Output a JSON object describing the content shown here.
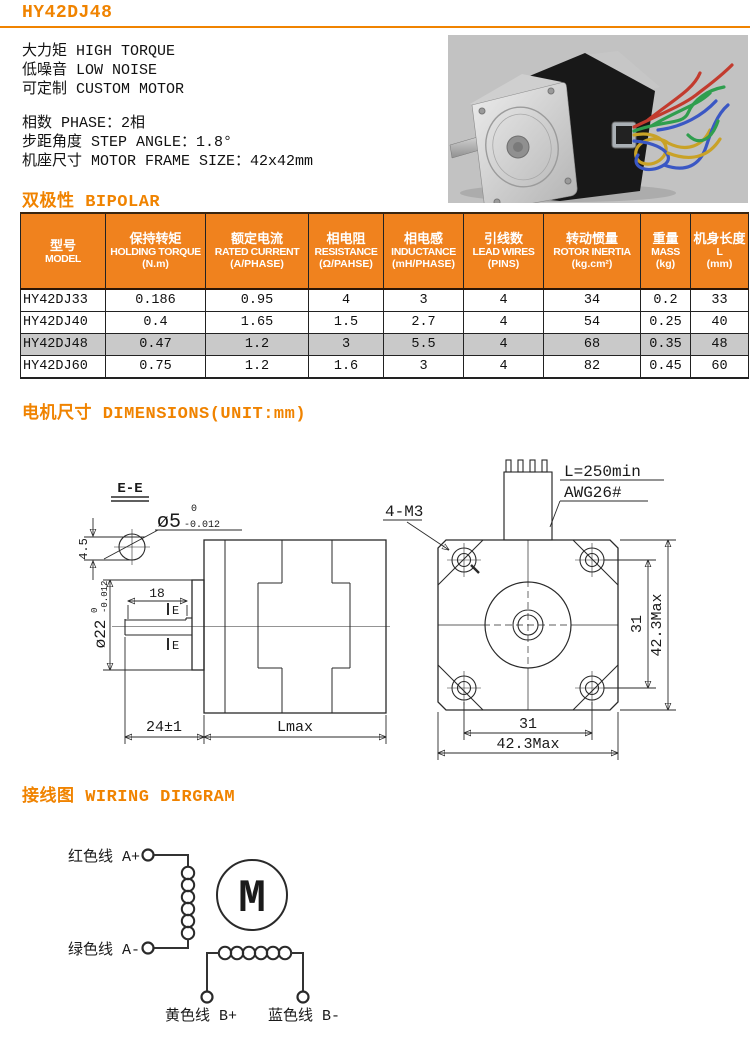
{
  "page": {
    "title": "HY42DJ48"
  },
  "colors": {
    "accent": "#F08300",
    "table_header_bg": "#F0821E",
    "highlight_row": "#C9C9C9",
    "photo_background": "#C2C2C2",
    "wire_colors": {
      "red": "#C23B2E",
      "green": "#2F9E4E",
      "blue": "#3A57C4",
      "yellow": "#C9A227"
    }
  },
  "intro": {
    "features": [
      "大力矩 HIGH TORQUE",
      "低噪音 LOW NOISE",
      "可定制 CUSTOM MOTOR"
    ],
    "specs": [
      "相数 PHASE：2相",
      "步距角度 STEP ANGLE：1.8°",
      "机座尺寸 MOTOR FRAME SIZE：42x42mm"
    ]
  },
  "sections": {
    "bipolar": "双极性 BIPOLAR",
    "dimensions": "电机尺寸 DIMENSIONS(UNIT:mm)",
    "wiring": "接线图 WIRING DIRGRAM"
  },
  "spec_table": {
    "headers": [
      {
        "cn": "型号",
        "en": "MODEL",
        "unit": ""
      },
      {
        "cn": "保持转矩",
        "en": "HOLDING TORQUE",
        "unit": "(N.m)"
      },
      {
        "cn": "额定电流",
        "en": "RATED CURRENT",
        "unit": "(A/PHASE)"
      },
      {
        "cn": "相电阻",
        "en": "RESISTANCE",
        "unit": "(Ω/PAHSE)"
      },
      {
        "cn": "相电感",
        "en": "INDUCTANCE",
        "unit": "(mH/PHASE)"
      },
      {
        "cn": "引线数",
        "en": "LEAD WIRES",
        "unit": "(PINS)"
      },
      {
        "cn": "转动惯量",
        "en": "ROTOR INERTIA",
        "unit": "(kg.cm²)"
      },
      {
        "cn": "重量",
        "en": "MASS",
        "unit": "(kg)"
      },
      {
        "cn": "机身长度",
        "en": "L",
        "unit": "(mm)"
      }
    ],
    "rows": [
      {
        "model": "HY42DJ33",
        "holding_torque": "0.186",
        "rated_current": "0.95",
        "resistance": "4",
        "inductance": "3",
        "lead_wires": "4",
        "rotor_inertia": "34",
        "mass": "0.2",
        "length": "33",
        "highlighted": false
      },
      {
        "model": "HY42DJ40",
        "holding_torque": "0.4",
        "rated_current": "1.65",
        "resistance": "1.5",
        "inductance": "2.7",
        "lead_wires": "4",
        "rotor_inertia": "54",
        "mass": "0.25",
        "length": "40",
        "highlighted": false
      },
      {
        "model": "HY42DJ48",
        "holding_torque": "0.47",
        "rated_current": "1.2",
        "resistance": "3",
        "inductance": "5.5",
        "lead_wires": "4",
        "rotor_inertia": "68",
        "mass": "0.35",
        "length": "48",
        "highlighted": true
      },
      {
        "model": "HY42DJ60",
        "holding_torque": "0.75",
        "rated_current": "1.2",
        "resistance": "1.6",
        "inductance": "3",
        "lead_wires": "4",
        "rotor_inertia": "82",
        "mass": "0.45",
        "length": "60",
        "highlighted": false
      }
    ]
  },
  "drawing": {
    "side_view": {
      "section": "E-E",
      "shaft_dia": "ø5",
      "shaft_tol_upper": "0",
      "shaft_tol_lower": "-0.012",
      "flat_depth": "4.5",
      "flat_length": "18",
      "section_marker": "E",
      "boss_dia": "ø22",
      "boss_tol_upper": "0",
      "boss_tol_lower": "-0.012",
      "shaft_length": "24±1",
      "body_length": "Lmax"
    },
    "front_view": {
      "mount_holes": "4-M3",
      "lead_length": "L=250min",
      "wire_gauge": "AWG26#",
      "hole_spacing_v": "31",
      "frame_size_v": "42.3Max",
      "hole_spacing_h": "31",
      "frame_size_h": "42.3Max"
    }
  },
  "wiring_diagram": {
    "phase_a_plus": "红色线 A+",
    "phase_a_minus": "绿色线 A-",
    "phase_b_plus": "黄色线 B+",
    "phase_b_minus": "蓝色线 B-",
    "motor_symbol": "M"
  }
}
